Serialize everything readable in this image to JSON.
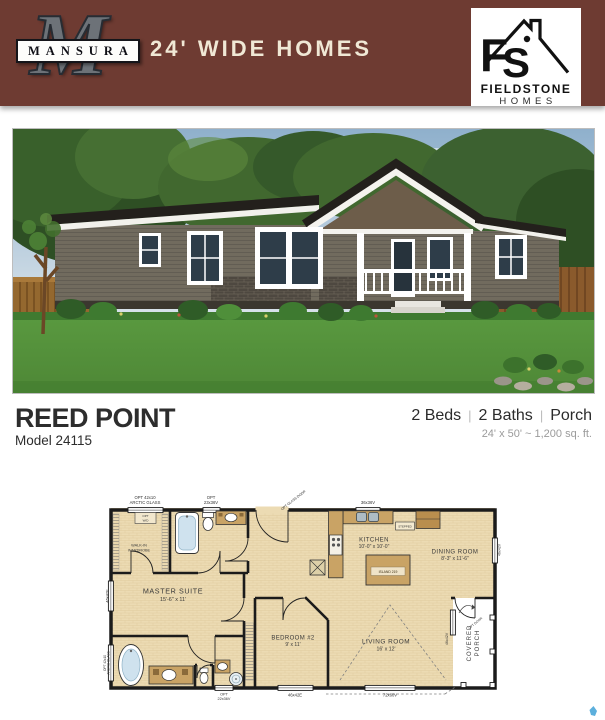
{
  "header": {
    "monogram": "M",
    "brand": "MANSURA",
    "tagline": "24' WIDE HOMES",
    "bg_color": "#6e3b32",
    "text_color": "#f0e8d5"
  },
  "fieldstone_logo": {
    "letter_f": "F",
    "letter_s": "S",
    "name": "FIELDSTONE",
    "sub": "HOMES"
  },
  "title": {
    "name": "REED POINT",
    "model": "Model 24115",
    "beds": "2 Beds",
    "baths": "2 Baths",
    "extra": "Porch",
    "separator": "|",
    "dimensions": "24' x 50' ~ 1,200 sq. ft."
  },
  "fp": {
    "master_name": "MASTER SUITE",
    "master_size": "15'-6\" x 11'",
    "wardrobe1": "WALK-IN",
    "wardrobe2": "WARDROBE",
    "kitchen_name": "KITCHEN",
    "kitchen_size": "10'-0\" x 10'-0\"",
    "dining_name": "DINING ROOM",
    "dining_size": "8'-3\" x 11'-6\"",
    "bed2_name": "BEDROOM #2",
    "bed2_size": "9' x 11'",
    "living_name": "LIVING ROOM",
    "living_size": "16' x 12'",
    "porch1": "COVERED",
    "porch2": "PORCH",
    "island": "ISLAND 219",
    "stepped": "STEPPED",
    "optwd1": "OPT",
    "optwd2": "W/D",
    "glassdoor": "OPT GLASS DOOR",
    "optdoor": "OPT DOOR",
    "arctic1": "OPT 42x10",
    "arctic2": "ARCTIC GLASS",
    "w2336_1": "OPT",
    "w2336_2": "23x36V",
    "w3636": "36x36V",
    "w4642e": "46x42E",
    "w2236_1": "OPT",
    "w2236_2": "22x36V",
    "w7260": "72x60V",
    "w4642v": "46x42V"
  },
  "colors": {
    "plan_floor": "#ecdbb3",
    "plan_wood": "#c9a365",
    "watermark": "#4aa6d8"
  }
}
